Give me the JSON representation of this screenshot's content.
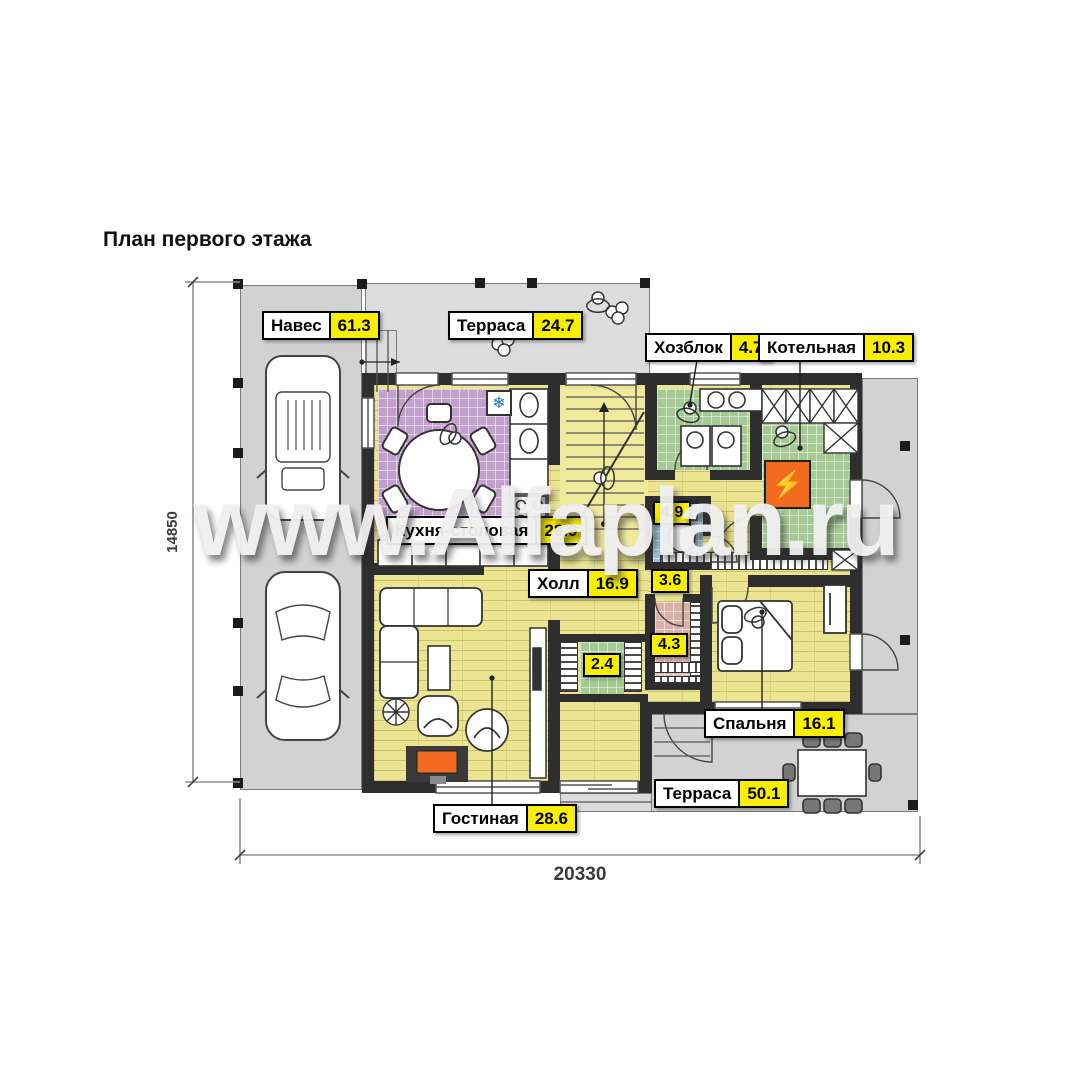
{
  "title": "План первого этажа",
  "watermark": "www.Alfaplan.ru",
  "dimensions": {
    "width_mm": "20330",
    "height_mm": "14850"
  },
  "rooms": {
    "carport": {
      "name": "Навес",
      "area": "61.3"
    },
    "terrace_top": {
      "name": "Терраса",
      "area": "24.7"
    },
    "utility": {
      "name": "Хозблок",
      "area": "4.7"
    },
    "boiler_room": {
      "name": "Котельная",
      "area": "10.3"
    },
    "kitchen": {
      "name": "Кухня-столовая",
      "area": "28.9"
    },
    "hall": {
      "name": "Холл",
      "area": "16.9"
    },
    "hall_niche": {
      "area": "4.9"
    },
    "corridor": {
      "area": "3.6"
    },
    "pantry": {
      "area": "2.4"
    },
    "wardrobe": {
      "area": "4.3"
    },
    "bedroom": {
      "name": "Спальня",
      "area": "16.1"
    },
    "terrace_bottom": {
      "name": "Терраса",
      "area": "50.1"
    },
    "living": {
      "name": "Гостиная",
      "area": "28.6"
    }
  },
  "icons": {
    "fridge": "❄",
    "boiler": "⚡"
  },
  "colors": {
    "label_yellow": "#f8ee00",
    "wall_dark": "#2e2e2e",
    "kitchen_floor": "#c2a0cd",
    "wood_floor": "#ebe592",
    "utility_floor": "#a5ca94",
    "wc_floor": "#9fc2d8",
    "wardrobe_floor": "#d8b2a9",
    "boiler_orange": "#f26b21",
    "slab_gray": "#d2d2d2"
  }
}
